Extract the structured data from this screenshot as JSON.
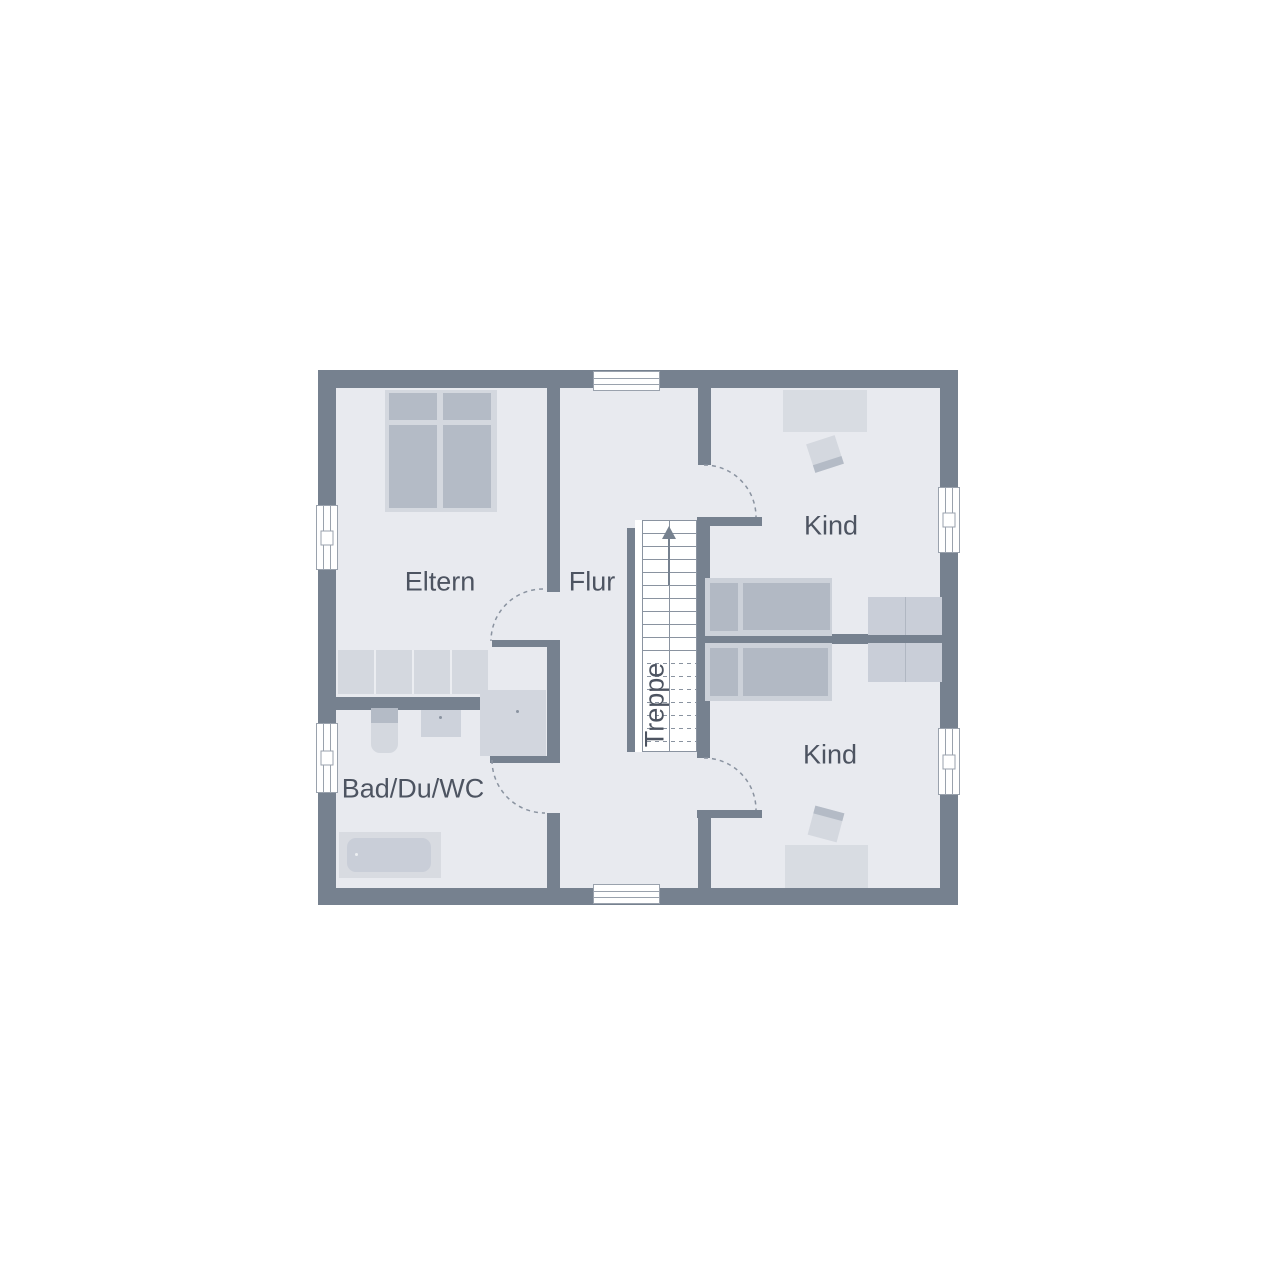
{
  "rooms": {
    "eltern": "Eltern",
    "flur": "Flur",
    "kind_top": "Kind",
    "kind_bottom": "Kind",
    "bad": "Bad/Du/WC",
    "treppe": "Treppe"
  },
  "colors": {
    "background": "#FFFFFF",
    "wall": "#76818F",
    "floor": "#E8EAEF",
    "furniture_light": "#D4D8DF",
    "furniture_dark": "#B4BBC6",
    "stair_fill": "#FFFFFF",
    "line": "#8A93A0",
    "label_text": "#4D5461"
  }
}
